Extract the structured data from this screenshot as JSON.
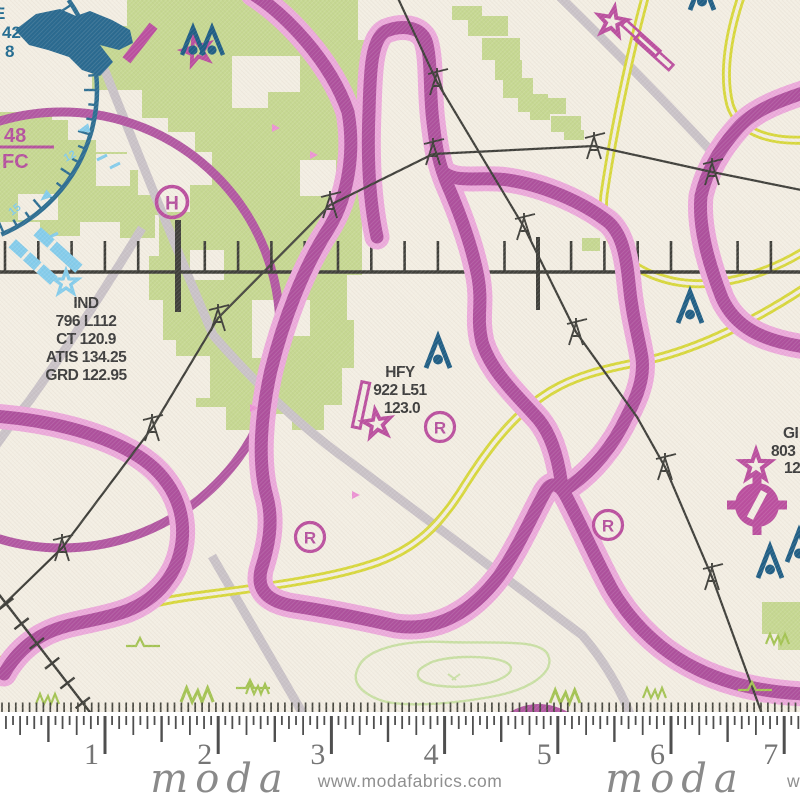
{
  "fabric": {
    "description": "aeronautical sectional chart print fabric swatch",
    "brand": "moda",
    "selvage_url": "www.modafabrics.com",
    "selvage_url_partial": "w",
    "ruler_numbers": [
      "1",
      "2",
      "3",
      "4",
      "5",
      "6",
      "7"
    ]
  },
  "map": {
    "airport_ind": {
      "l1": "IND",
      "l2": "796 L112",
      "l3": "CT 120.9",
      "l4": "ATIS 134.25",
      "l5": "GRD 122.95"
    },
    "airport_hfy": {
      "l1": "HFY",
      "l2": "922 L51",
      "l3": "123.0"
    },
    "airport_partial_right": {
      "l1": "GI",
      "l2": "803",
      "l3": "12"
    },
    "teal_partial_left": {
      "l1": "E",
      "l2": "42",
      "l3": "8"
    },
    "airspace_fraction": {
      "top": "48",
      "bottom": "FC"
    },
    "heliport_letter": "H",
    "restricted_letter": "R",
    "compass_numbers": {
      "n1": "12",
      "n2": "15"
    }
  },
  "colors": {
    "cream_background": "#f3eee3",
    "land_green": "#c6d892",
    "contour_green": "#c9e0a4",
    "glyph_green": "#a4c453",
    "airspace_magenta": "#ae509d",
    "airspace_halo_pink": "#ecaadb",
    "symbol_magenta": "#bb4f9f",
    "flag_pink": "#ec93d4",
    "teal_dark": "#24618a",
    "light_blue": "#85cdec",
    "road_yellow": "#d8d83c",
    "road_gray": "#cac3c8",
    "line_black": "#3f3f3a",
    "selvage_white": "#ffffff",
    "selvage_gray": "#8a8a8a"
  }
}
